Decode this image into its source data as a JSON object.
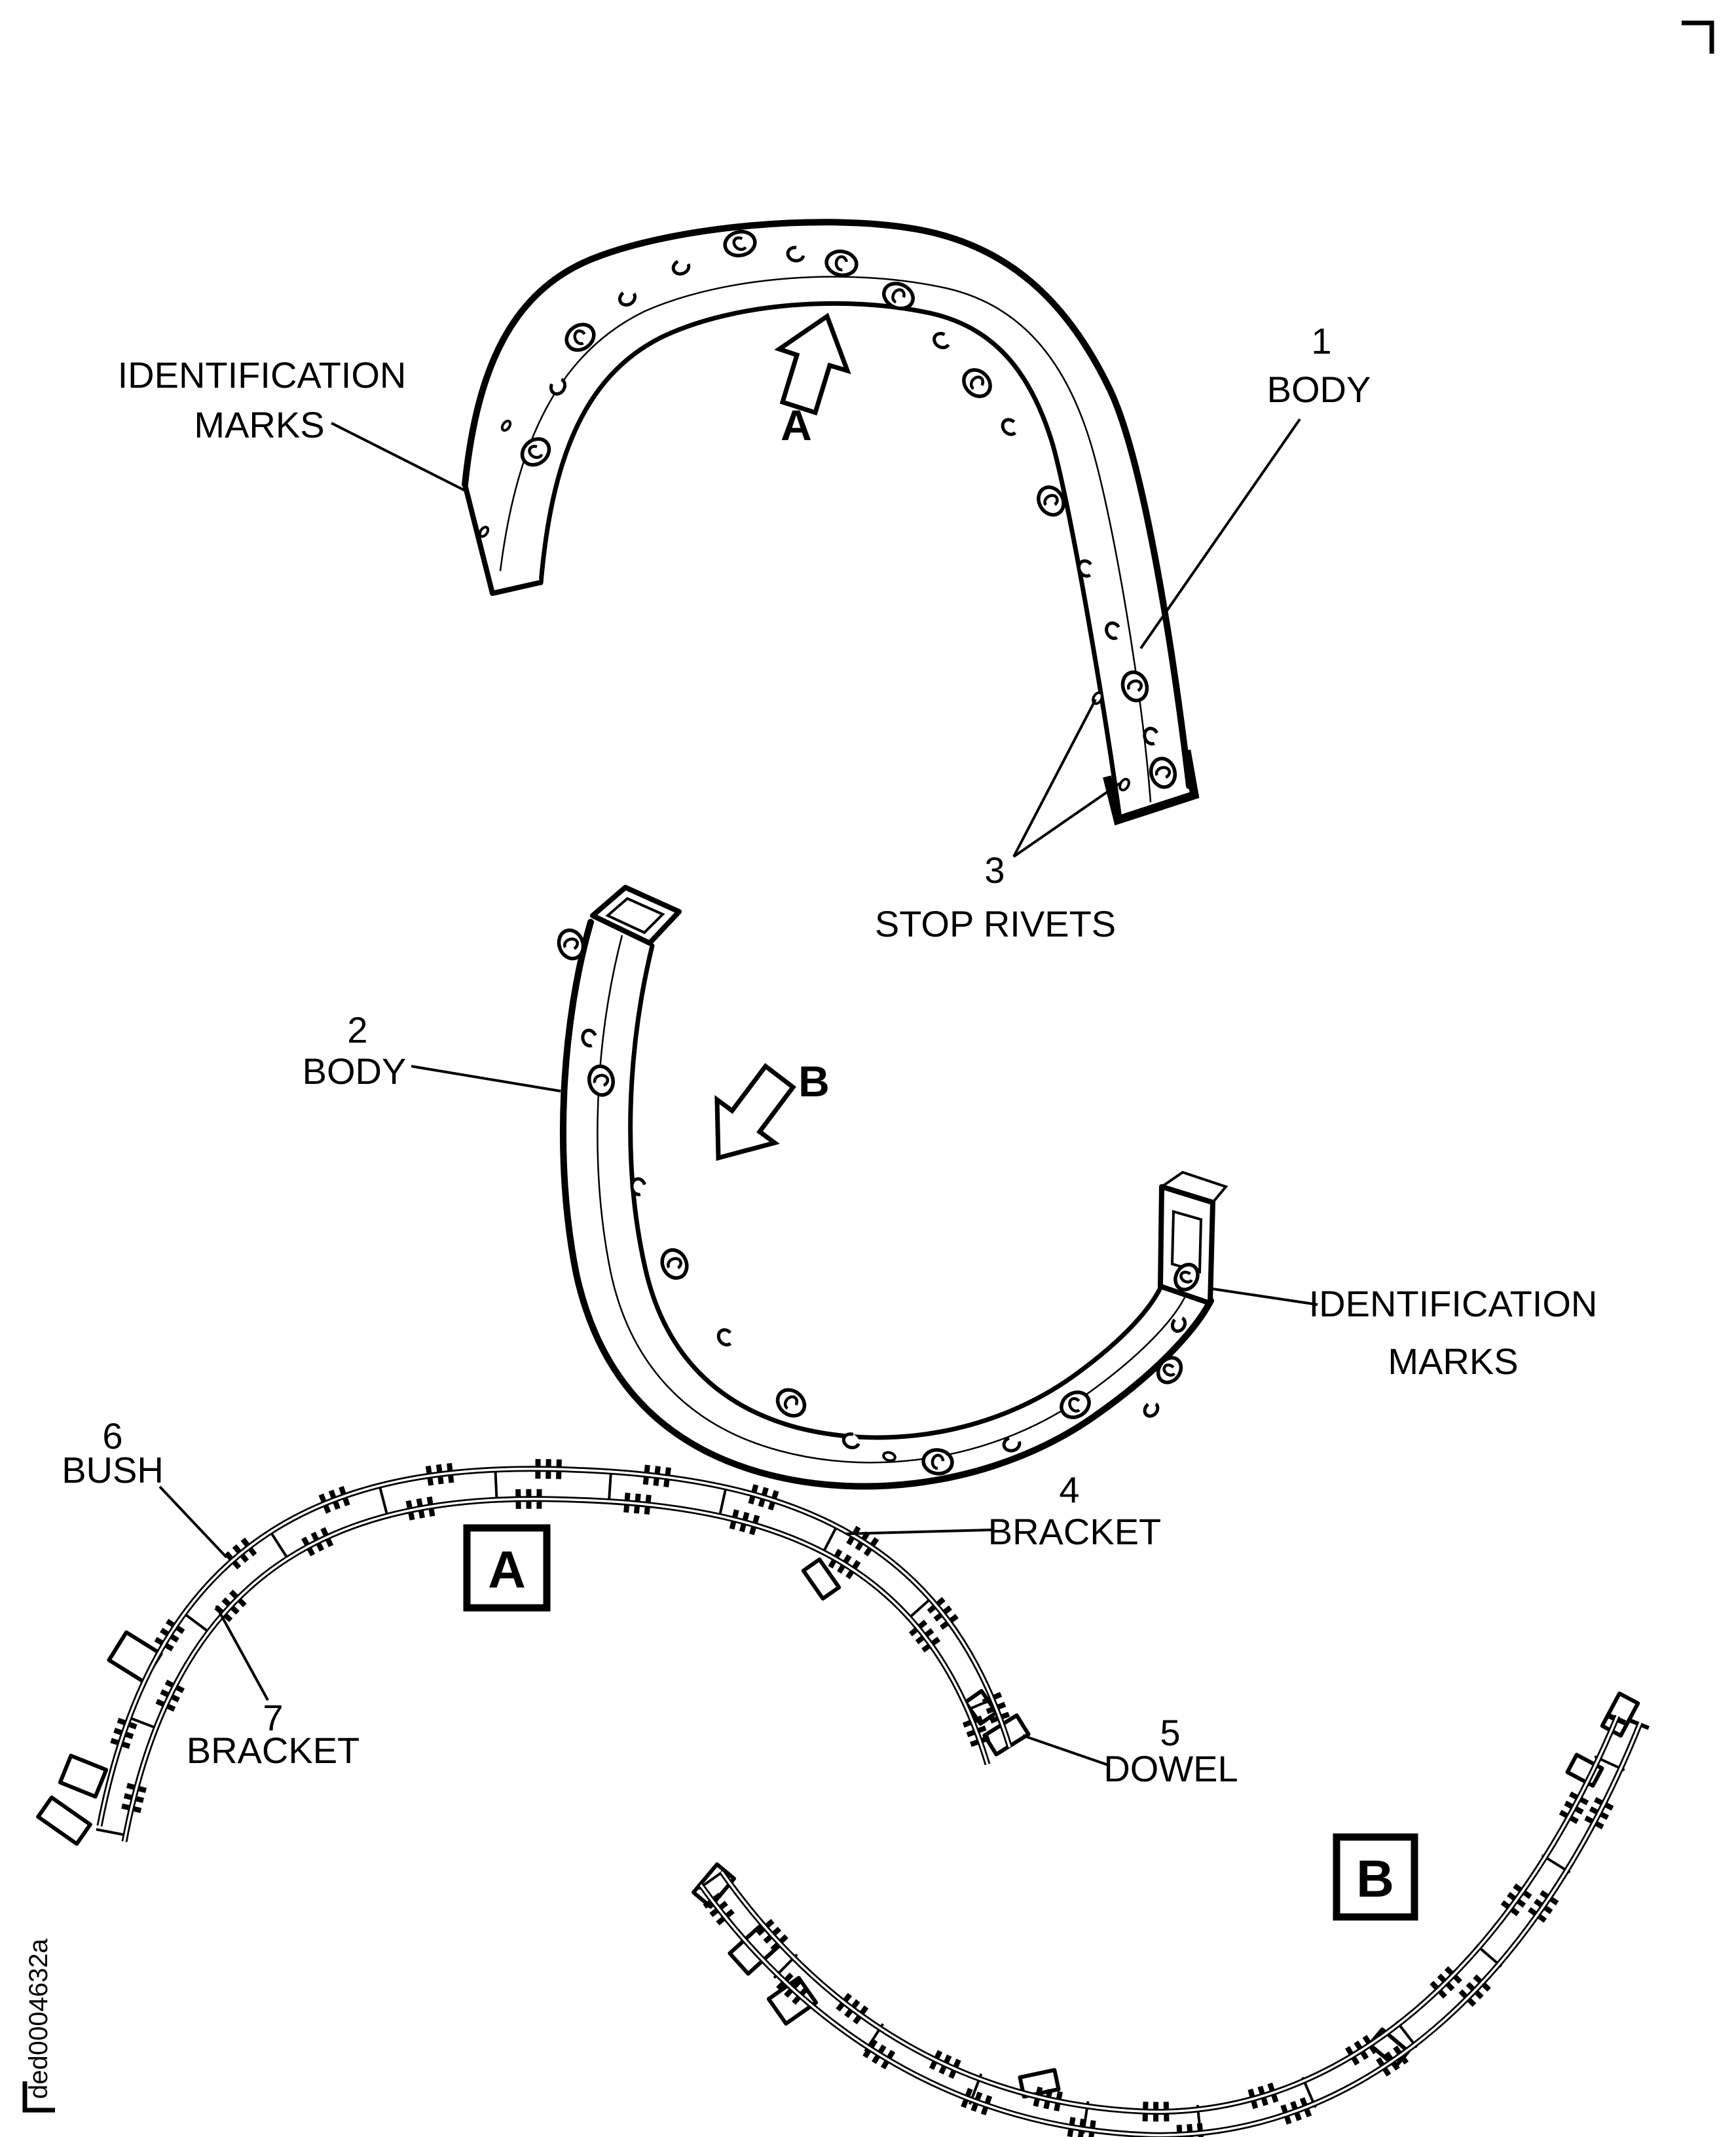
{
  "page": {
    "background": "#ffffff",
    "ink": "#000000",
    "figure_code": "ded0004632a"
  },
  "labels": {
    "id_marks_top": {
      "line1": "IDENTIFICATION",
      "line2": "MARKS"
    },
    "body1": {
      "number": "1",
      "name": "BODY"
    },
    "view_arrow_a": "A",
    "stop_rivets": {
      "number": "3",
      "name": "STOP RIVETS"
    },
    "body2": {
      "number": "2",
      "name": "BODY"
    },
    "view_arrow_b": "B",
    "id_marks_right": {
      "line1": "IDENTIFICATION",
      "line2": "MARKS"
    },
    "bush": {
      "number": "6",
      "name": "BUSH"
    },
    "bracket_upper": {
      "number": "4",
      "name": "BRACKET"
    },
    "bracket_lower": {
      "number": "7",
      "name": "BRACKET"
    },
    "dowel": {
      "number": "5",
      "name": "DOWEL"
    },
    "detail_a": "A",
    "detail_b": "B"
  }
}
